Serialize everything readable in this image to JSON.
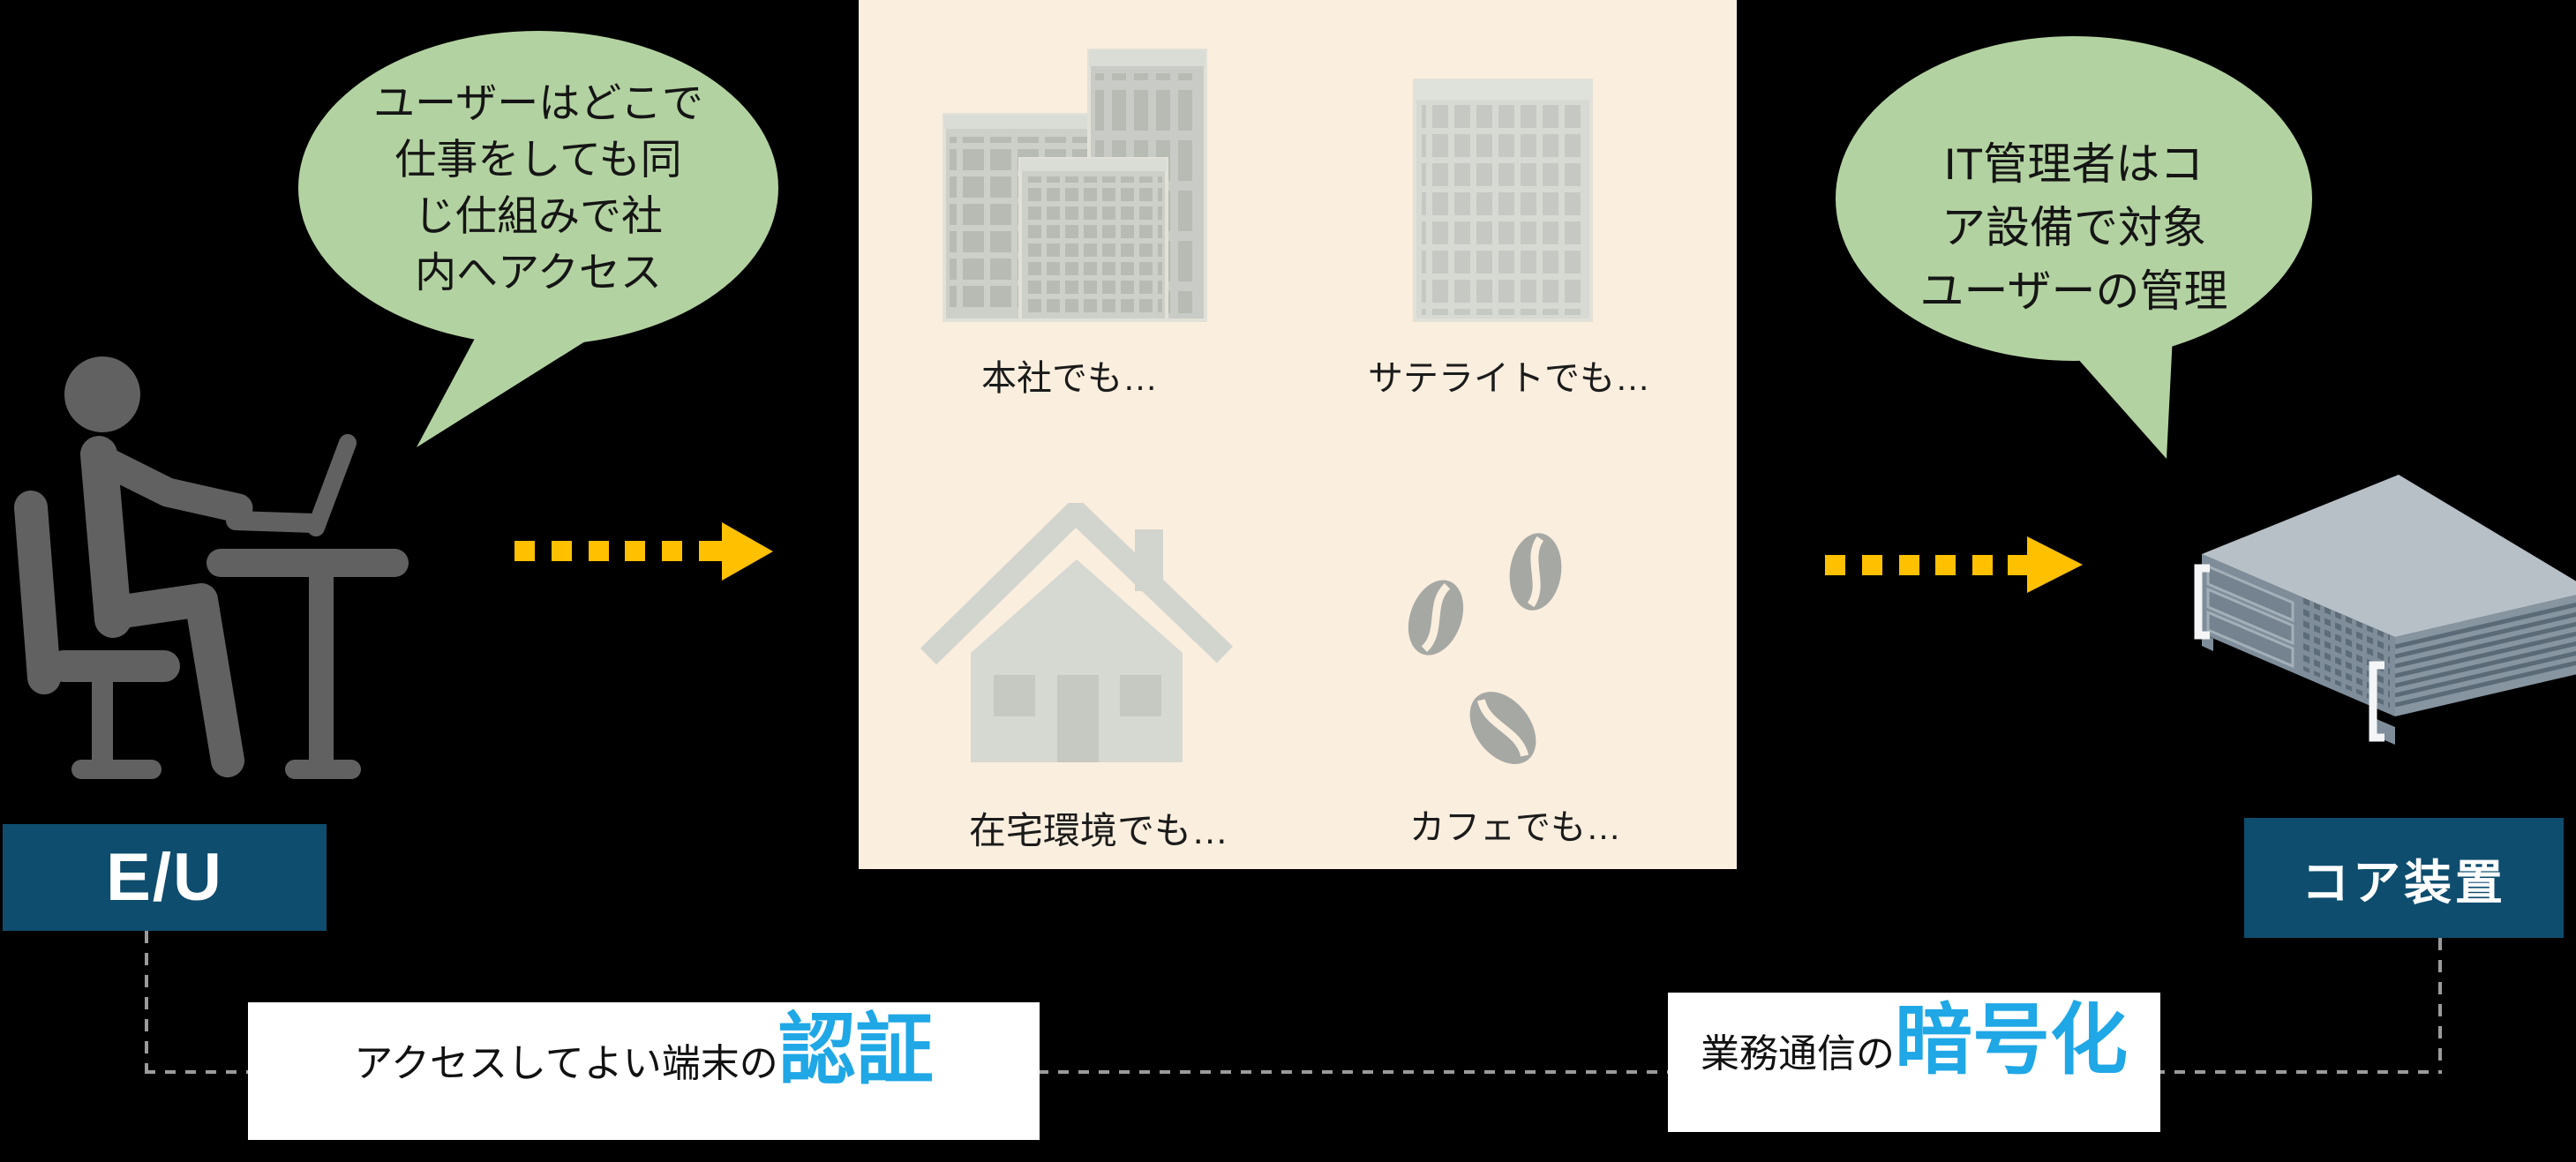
{
  "colors": {
    "background": "#000000",
    "bubble_green": "#b3d2a1",
    "panel_beige": "#faeede",
    "label_navy": "#0e4d6e",
    "arrow_yellow": "#ffc000",
    "highlight_blue": "#1fa7e6",
    "connector_gray": "#9b9b9b",
    "pictogram_gray": "#616161"
  },
  "end_user": {
    "bubble_lines": [
      "ユーザーはどこで",
      "仕事をしても同",
      "じ仕組みで社",
      "内へアクセス"
    ],
    "label": "E/U",
    "icon": "person-at-desk-icon"
  },
  "locations_panel": {
    "headquarters_label": "本社でも…",
    "satellite_label": "サテライトでも…",
    "home_label": "在宅環境でも…",
    "cafe_label": "カフェでも…"
  },
  "core_device": {
    "bubble_lines": [
      "IT管理者はコ",
      "ア設備で対象",
      "ユーザーの管理"
    ],
    "label": "コア装置",
    "icon": "rack-server-icon"
  },
  "callouts": {
    "device_auth": {
      "prefix": "アクセスしてよい端末の",
      "highlight": "認証"
    },
    "encryption": {
      "prefix": "業務通信の",
      "highlight": "暗号化"
    }
  }
}
